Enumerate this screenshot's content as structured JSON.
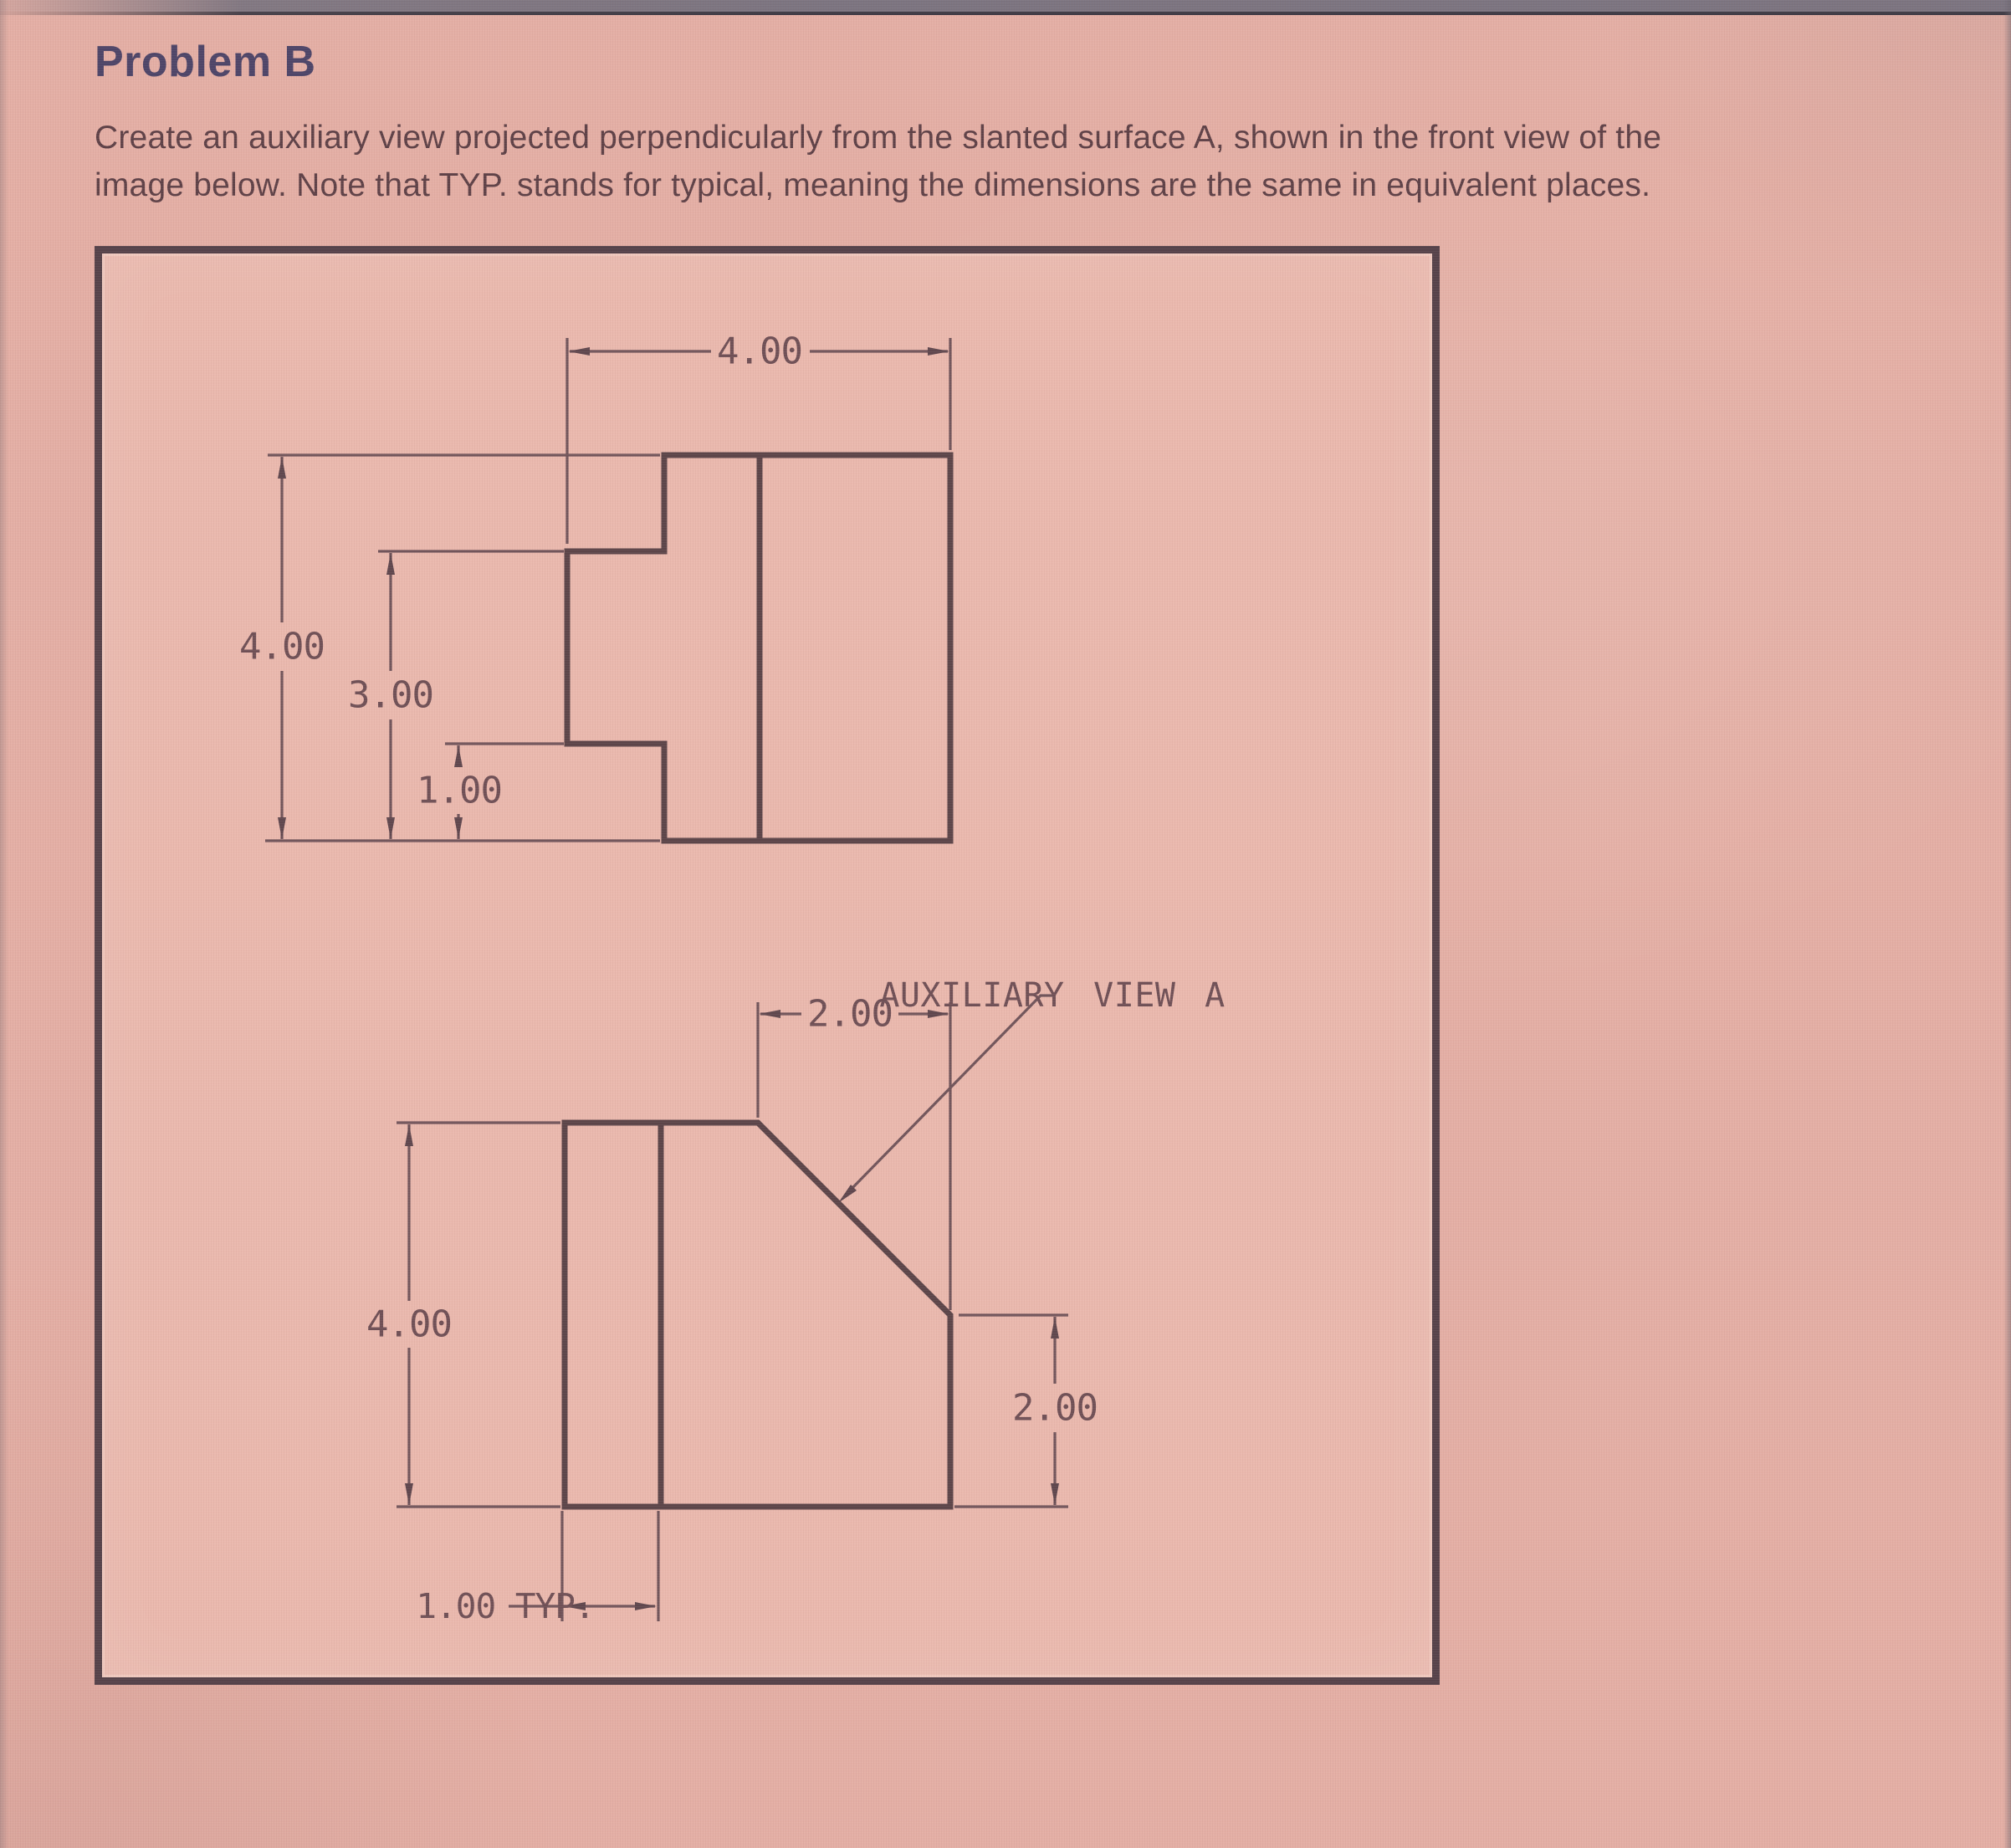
{
  "page": {
    "title": "Problem B",
    "instructions": {
      "line1": "Create an auxiliary view projected perpendicularly from the slanted surface A, shown in the front view of the",
      "line2": "image below. Note that TYP. stands for typical, meaning the dimensions are the same in equivalent places."
    }
  },
  "drawing": {
    "top_view": {
      "width_top": "4.00",
      "height_overall": "4.00",
      "height_step": "3.00",
      "height_notch": "1.00"
    },
    "front_view": {
      "height_overall": "4.00",
      "width_chamfer_top": "2.00",
      "height_chamfer_right": "2.00",
      "thickness_typical": "1.00 TYP.",
      "callout_label": "AUXILIARY VIEW A"
    }
  },
  "colors": {
    "page_background": "#e4afa5",
    "frame_background": "#eab9ae",
    "frame_border": "#55424a",
    "object_line": "#5c4549",
    "dimension_line": "#71555b",
    "dimension_text": "#6f5056",
    "title_text": "#4d4568",
    "body_text": "#5e4147",
    "bezel_gray": "#7b7480"
  }
}
